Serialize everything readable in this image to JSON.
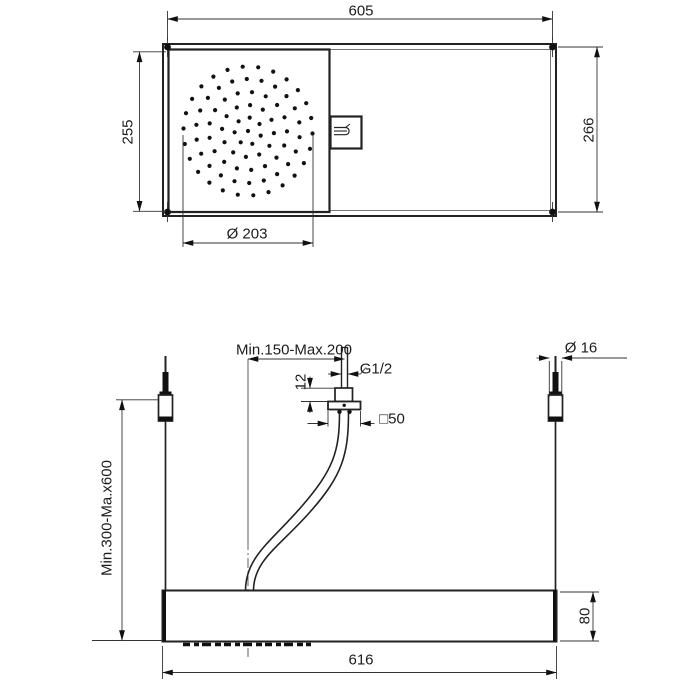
{
  "top_view": {
    "overall_width": "605",
    "head_height": "255",
    "panel_height": "266",
    "spray_face_diameter": "Ø 203"
  },
  "front_view": {
    "inlet_offset_range": "Min.150-Max.200",
    "inlet_thread": "G1/2",
    "thread_exposure": "12",
    "escutcheon_size": "□50",
    "rod_diameter": "Ø 16",
    "hanging_range": "Min.300-Ma.x600",
    "panel_thickness": "80",
    "overall_width": "616"
  },
  "colors": {
    "line": "#222222",
    "thin_line": "#3a3a3a",
    "ink": "#111111",
    "background": "#ffffff"
  }
}
